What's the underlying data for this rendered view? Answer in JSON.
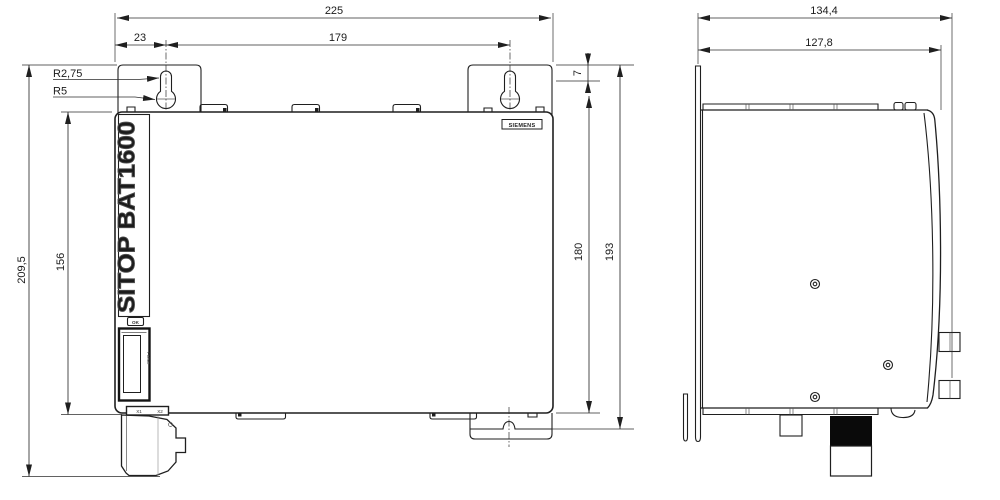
{
  "drawing": {
    "front_view": {
      "dim_total_width": "225",
      "dim_keyhole_offset": "23",
      "dim_keyhole_pitch": "179",
      "dim_slot_radius": "R2,75",
      "dim_hole_radius": "R5",
      "dim_flange_drop": "7",
      "dim_body_height": "180",
      "dim_height_with_tab": "193",
      "dim_total_height": "209,5",
      "dim_front_face_height": "156",
      "brand_label": "SIEMENS",
      "product_label": "SITOP BAT1600",
      "ok_label": "OK",
      "fuse_label": "FUSE",
      "terminal_x1": "X1",
      "terminal_x2": "X2"
    },
    "side_view": {
      "dim_total_depth": "134,4",
      "dim_body_depth": "127,8"
    },
    "colors": {
      "line": "#1f1f1f",
      "dimension_line": "#2e2e2e",
      "background": "#ffffff",
      "connector_fill": "#0a0a0a"
    }
  }
}
